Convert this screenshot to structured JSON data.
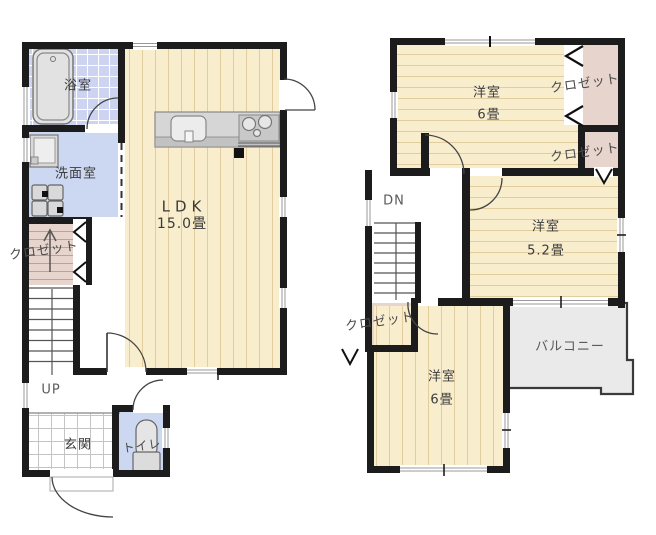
{
  "floor1": {
    "bathroom": "浴室",
    "washroom": "洗面室",
    "closet": "クロゼット",
    "ldk_name": "LDK",
    "ldk_size": "15.0畳",
    "stairs_up": "UP",
    "entrance": "玄関",
    "toilet": "トイレ"
  },
  "floor2": {
    "bedroom1_name": "洋室",
    "bedroom1_size": "6畳",
    "closet1": "クロゼット",
    "closet2": "クロゼット",
    "closet3": "クロゼット",
    "stairs_down": "DN",
    "bedroom2_name": "洋室",
    "bedroom2_size": "5.2畳",
    "balcony": "バルコニー",
    "bedroom3_name": "洋室",
    "bedroom3_size": "6畳"
  },
  "colors": {
    "wall": "#1c1c1c",
    "tatami_cream": "#f8edcd",
    "tatami_line": "#e2cd9e",
    "bath_tile": "#cdd4f1",
    "water_blue": "#ccd8f2",
    "closet_pink": "#e7d4cc",
    "balcony_gray": "#eaeaea"
  }
}
